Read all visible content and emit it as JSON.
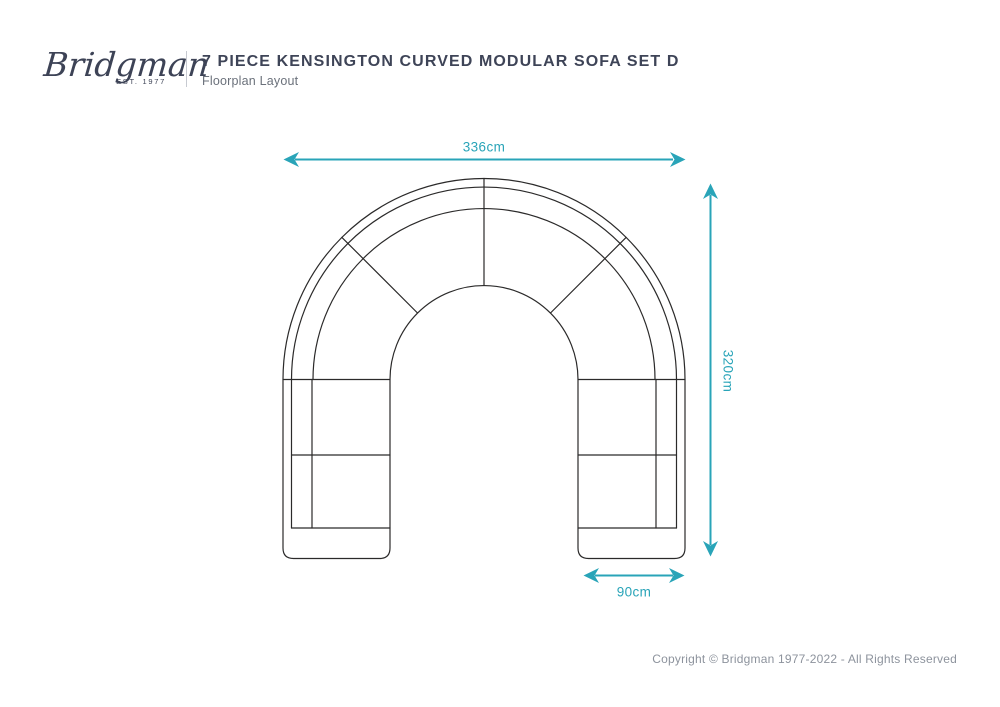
{
  "brand": {
    "name": "Bridgman",
    "established": "EST. 1977"
  },
  "header": {
    "title": "7 PIECE KENSINGTON CURVED MODULAR SOFA SET D",
    "subtitle": "Floorplan Layout"
  },
  "diagram": {
    "type": "sofa-floorplan",
    "shape": "u-shaped curved modular sofa, top-down view",
    "dimensions": {
      "overall_width": "336cm",
      "overall_depth": "320cm",
      "module_width": "90cm"
    },
    "accent_color": "#29a4b8",
    "outline_color": "#2b2a2a"
  },
  "footer": {
    "copyright": "Copyright © Bridgman 1977-2022 - All Rights Reserved"
  }
}
